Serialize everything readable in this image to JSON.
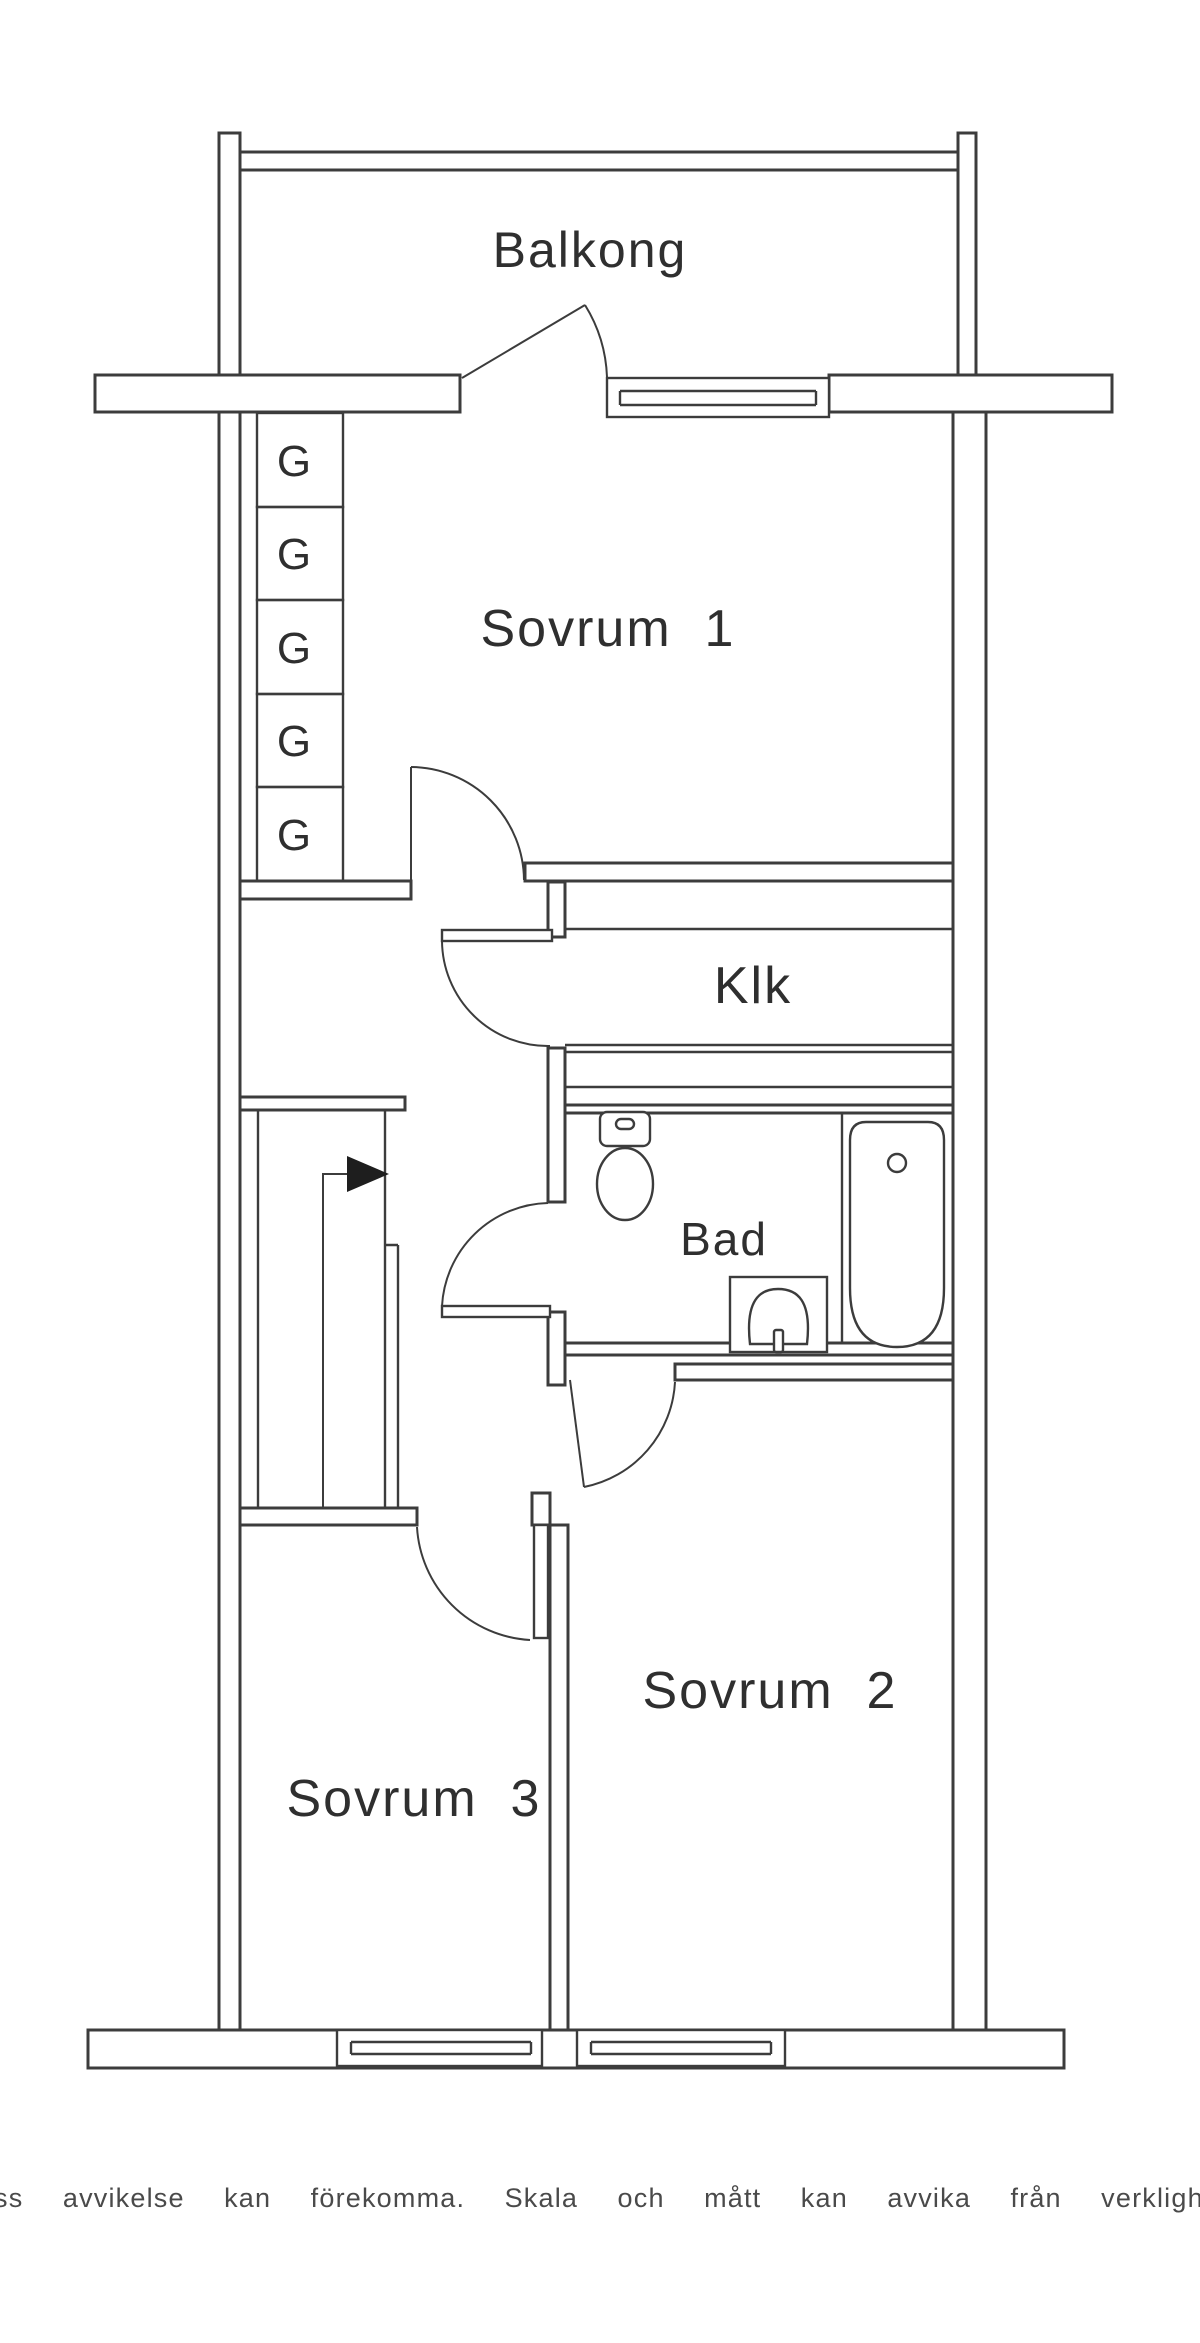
{
  "floorplan": {
    "rooms": {
      "balcony": {
        "label": "Balkong"
      },
      "bedroom1": {
        "label": "Sovrum  1"
      },
      "closet": {
        "label": "Klk"
      },
      "bathroom": {
        "label": "Bad"
      },
      "bedroom2": {
        "label": "Sovrum  2"
      },
      "bedroom3": {
        "label": "Sovrum  3"
      }
    },
    "wardrobe": {
      "label": "G",
      "count": 5
    },
    "icons": {
      "stairs_arrow": "stairs-up-arrow"
    },
    "colors": {
      "line": "#3c3c3c",
      "background": "#ffffff",
      "text": "#2f2f2f"
    }
  },
  "footer": {
    "disclaimer": "Viss  avvikelse  kan  förekomma.  Skala  och  mått  kan  avvika  från  verkligheten."
  }
}
